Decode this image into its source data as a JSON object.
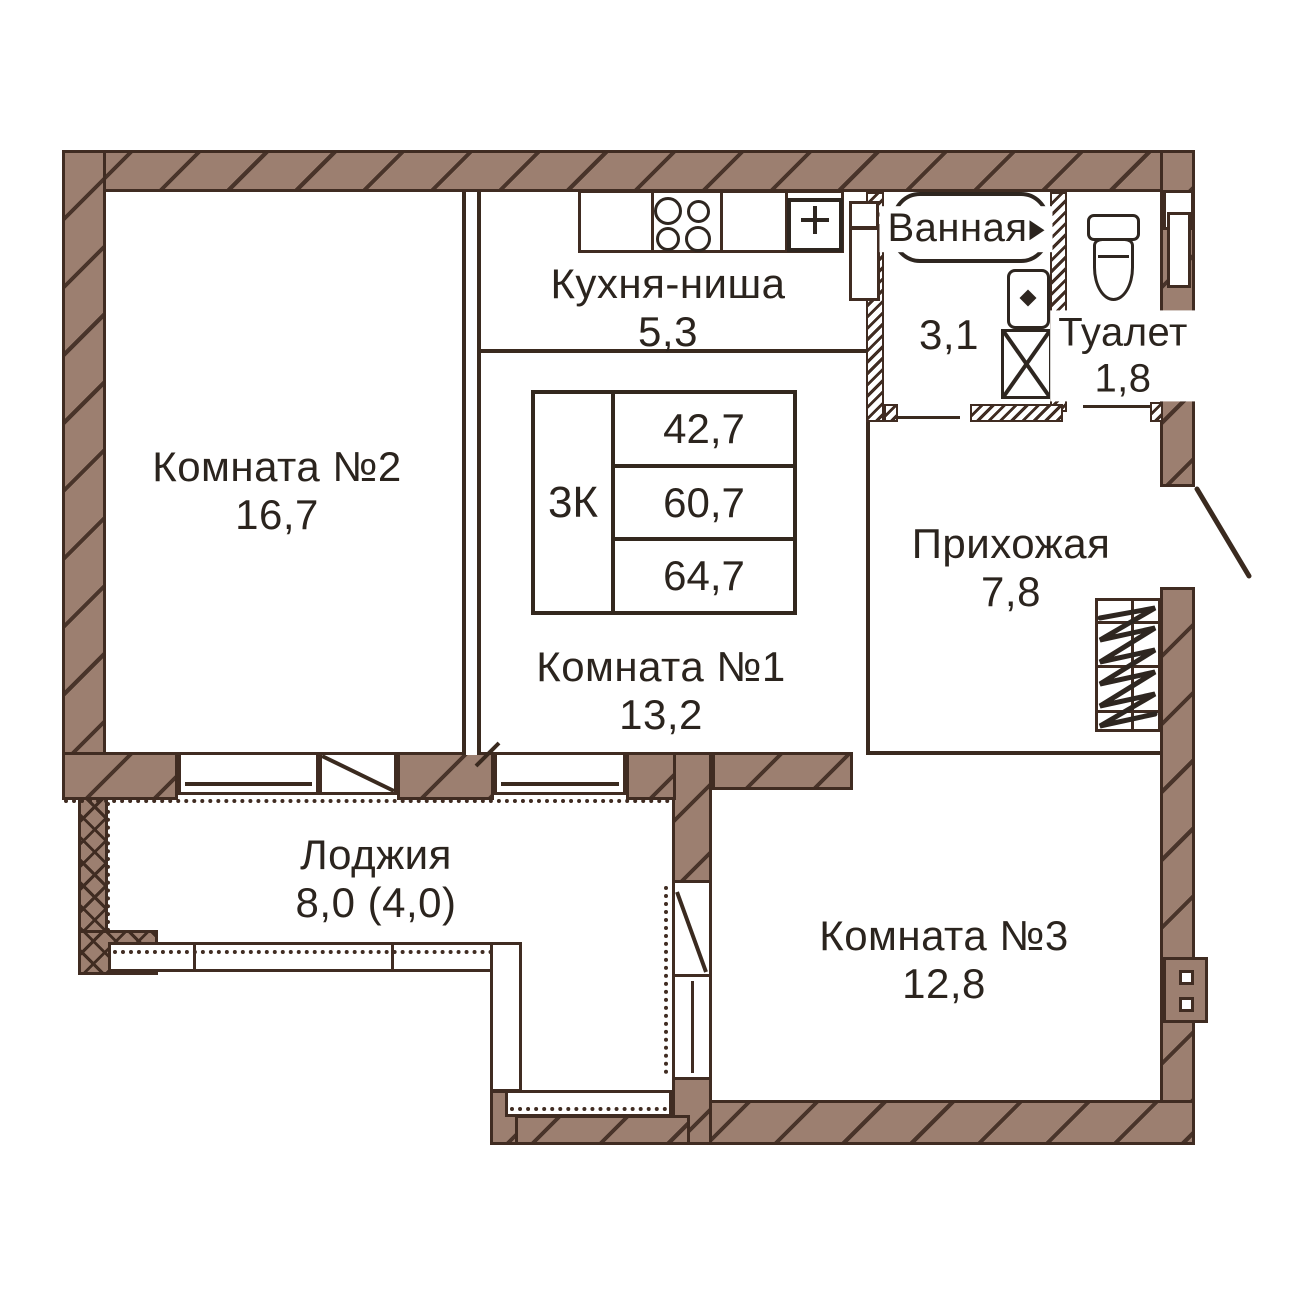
{
  "plan": {
    "type": "apartment-floor-plan",
    "rooms": [
      {
        "id": "room2",
        "name": "Комната №2",
        "area": "16,7"
      },
      {
        "id": "kitchen",
        "name": "Кухня-ниша",
        "area": "5,3"
      },
      {
        "id": "room1",
        "name": "Комната №1",
        "area": "13,2"
      },
      {
        "id": "bathroom",
        "name": "Ванная",
        "area": "3,1"
      },
      {
        "id": "toilet",
        "name": "Туалет",
        "area": "1,8"
      },
      {
        "id": "hallway",
        "name": "Прихожая",
        "area": "7,8"
      },
      {
        "id": "room3",
        "name": "Комната №3",
        "area": "12,8"
      },
      {
        "id": "loggia",
        "name": "Лоджия",
        "area": "8,0 (4,0)"
      }
    ],
    "summary_table": {
      "apartment_type": "3К",
      "rows": [
        "42,7",
        "60,7",
        "64,7"
      ]
    },
    "icons": {
      "bathtub-icon": "rounded rectangle outline",
      "faucet-icon": "small right-pointing triangle",
      "washbasin-icon": "rounded rect with diamond",
      "washing-machine-icon": "square with X diagonals",
      "toilet-icon": "tank rectangle with oval bowl",
      "stove-icon": "four burner circles",
      "kitchen-sink-icon": "square with plus cross",
      "wardrobe-icon": "rectangle with hanger zigzag",
      "entry-door-icon": "diagonal door leaf line",
      "vent-shaft-icon": "wall block with square holes",
      "window-icon": "white band with dotted sill"
    },
    "colors": {
      "background": "#ffffff",
      "wall_fill": "#9c7f70",
      "outline": "#402c22",
      "text": "#2b241e"
    }
  }
}
